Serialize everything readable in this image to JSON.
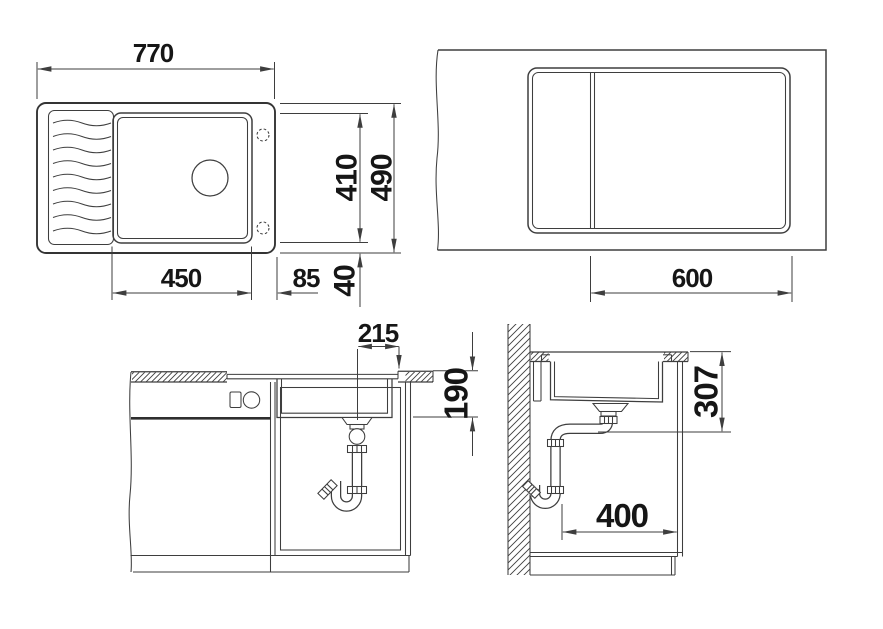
{
  "title": "sink-installation-technical-drawing",
  "colors": {
    "line": "#3e3e3e",
    "text": "#161616",
    "background": "#ffffff"
  },
  "views": {
    "top": {
      "name": "sink-top-view",
      "dims": {
        "overall_width": "770",
        "overall_depth": "490",
        "bowl_length": "410",
        "bowl_width": "450",
        "right_offset": "85",
        "edge_gap": "40"
      }
    },
    "plan": {
      "name": "countertop-cutout-plan-view",
      "dims": {
        "cabinet_width": "600"
      }
    },
    "front": {
      "name": "front-section-view",
      "dims": {
        "drain_offset": "215",
        "bowl_depth": "190"
      }
    },
    "side": {
      "name": "side-section-view",
      "dims": {
        "drain_height": "307",
        "clearance_depth": "400"
      }
    }
  }
}
